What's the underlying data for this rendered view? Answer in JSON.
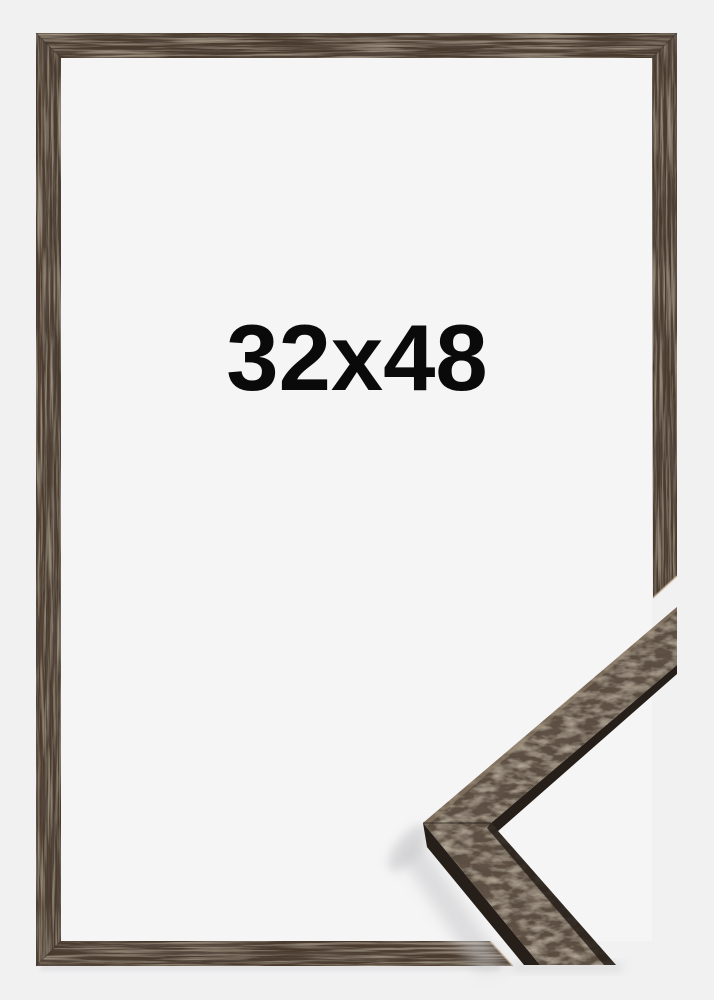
{
  "product_image": {
    "size_label": "32x48",
    "theme": {
      "outer_background": "#f1f1f2",
      "inner_background": "#f5f5f6",
      "frame_wood": "#483a2f",
      "sample_face": "#5e5144",
      "sample_edge_dark": "#261f19",
      "sample_highlight": "#96846d",
      "shadow": "#c4c4c6",
      "label_color": "#0a0a0a"
    }
  }
}
